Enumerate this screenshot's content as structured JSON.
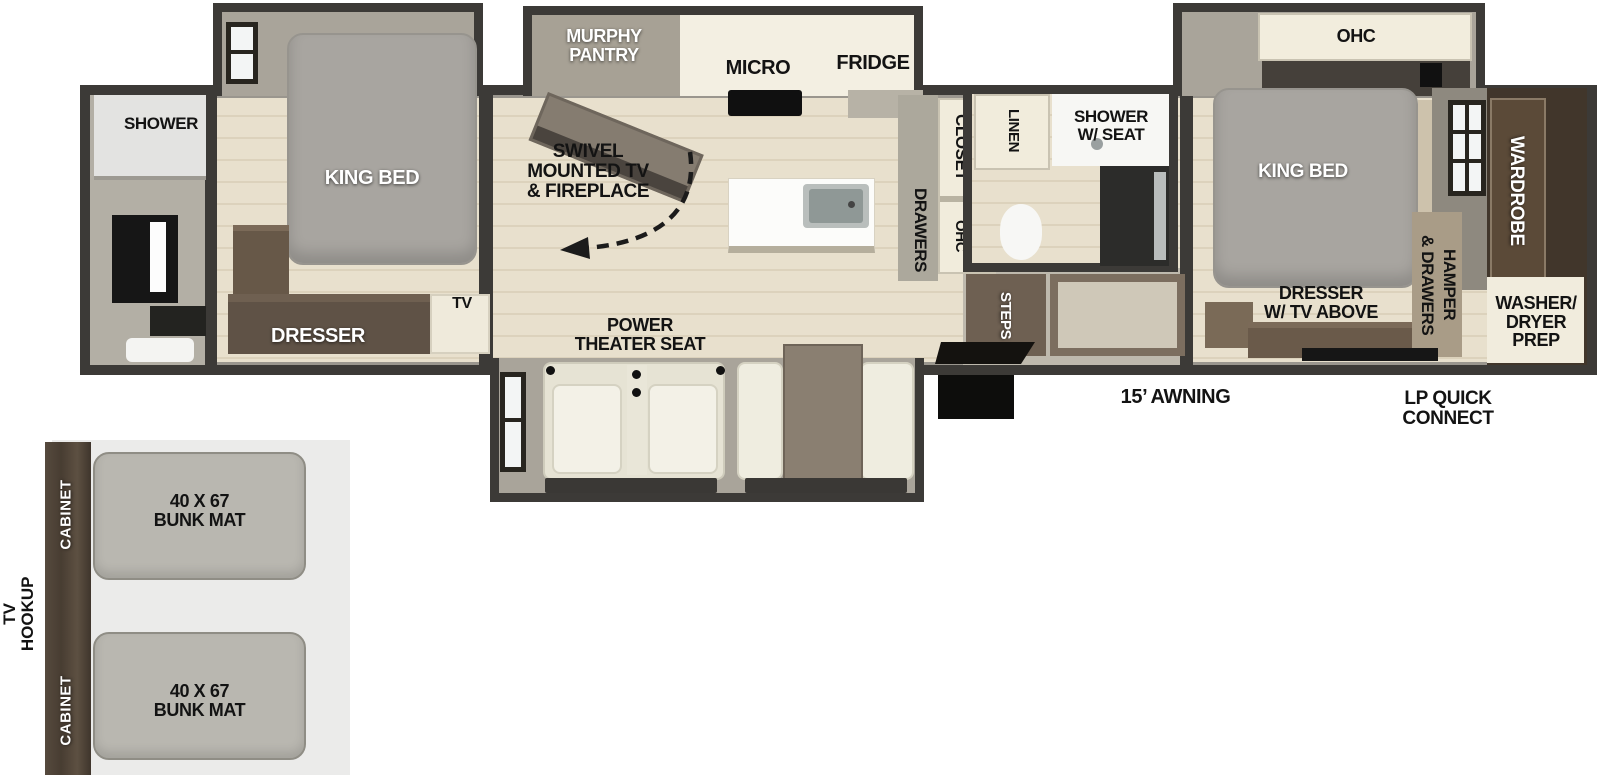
{
  "colors": {
    "wall": "#3c3a37",
    "floor_beige": "#e7dfcc",
    "cabinet_cream": "#f1ecdc",
    "slide_gray": "#a9a49a",
    "furniture_brown": "#5f5246",
    "wardrobe_brown": "#41362b",
    "inset_background": "#ebebea",
    "mat_gray": "#b9b7b0"
  },
  "floorplan": {
    "front_bath": {
      "shower": "SHOWER"
    },
    "front_bedroom": {
      "king_bed": "KING BED",
      "dresser": "DRESSER",
      "tv": "TV"
    },
    "kitchen": {
      "murphy_pantry": [
        "MURPHY",
        "PANTRY"
      ],
      "micro": "MICRO",
      "fridge": "FRIDGE",
      "swivel": [
        "SWIVEL",
        "MOUNTED TV",
        "& FIREPLACE"
      ],
      "closet": "CLOSET",
      "drawers": "DRAWERS",
      "ohc": "OHC"
    },
    "living": {
      "theater": [
        "POWER",
        "THEATER SEAT"
      ]
    },
    "mid_bath": {
      "linen": "LINEN",
      "shower_seat": [
        "SHOWER",
        "W/ SEAT"
      ],
      "steps": "STEPS"
    },
    "rear_bedroom": {
      "ohc": "OHC",
      "king_bed": "KING BED",
      "wardrobe": "WARDROBE",
      "hamper": [
        "HAMPER",
        "& DRAWERS"
      ],
      "dresser_tv": [
        "DRESSER",
        "W/ TV ABOVE"
      ],
      "washer": [
        "WASHER/",
        "DRYER",
        "PREP"
      ]
    },
    "exterior": {
      "awning": "15’ AWNING",
      "lp": [
        "LP QUICK",
        "CONNECT"
      ]
    }
  },
  "bunk_inset": {
    "cabinet": "CABINET",
    "mat": [
      "40 X 67",
      "BUNK MAT"
    ],
    "tv_hookup": [
      "TV",
      "HOOKUP"
    ]
  }
}
